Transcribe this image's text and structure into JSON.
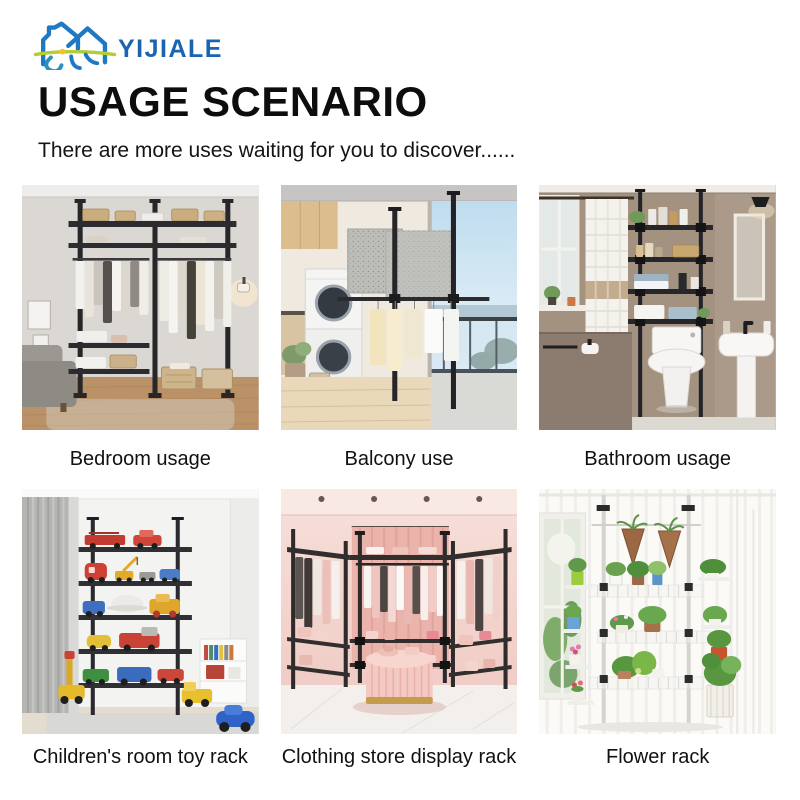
{
  "brand": {
    "name": "YIJIALE",
    "accent_blue": "#1a64b2",
    "icon_green": "#b5cc34",
    "icon_yellow": "#f0c32e",
    "icon": "house-logo-icon"
  },
  "header": {
    "title": "USAGE SCENARIO",
    "subtitle": "There are more uses waiting for you to discover......"
  },
  "grid": {
    "items": [
      {
        "label": "Bedroom usage",
        "image": "bedroom-clothes-rack-photo"
      },
      {
        "label": "Balcony use",
        "image": "balcony-drying-rack-photo"
      },
      {
        "label": "Bathroom usage",
        "image": "bathroom-over-toilet-shelf-photo"
      },
      {
        "label": "Children's room toy rack",
        "image": "toy-rack-photo"
      },
      {
        "label": "Clothing store display rack",
        "image": "clothing-store-rack-photo"
      },
      {
        "label": "Flower rack",
        "image": "flower-rack-photo"
      }
    ]
  }
}
